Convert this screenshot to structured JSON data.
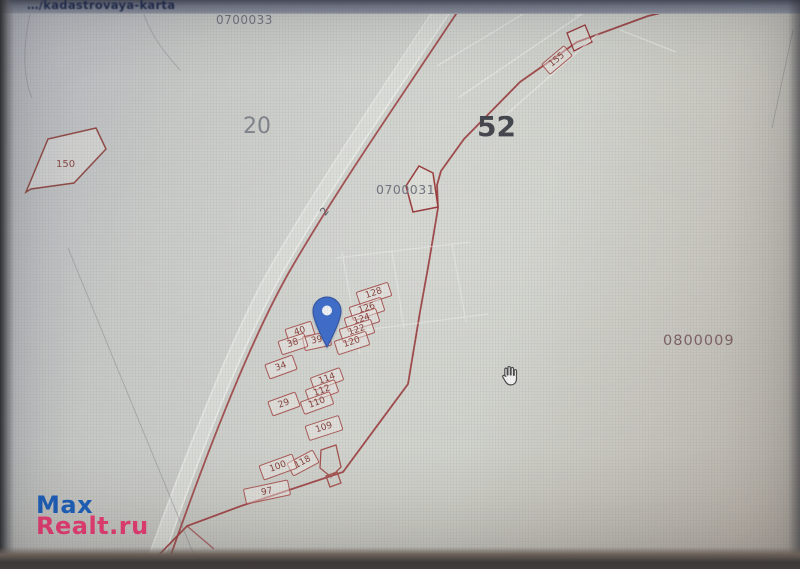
{
  "browser": {
    "address_fragment": "…/kadastrovaya-karta"
  },
  "map": {
    "labels": {
      "q_top": "0700033",
      "zone_left": "20",
      "zone_right": "52",
      "q_mid": "0700031",
      "q_right": "0800009",
      "road": "2",
      "parcel_150": "150"
    },
    "parcels": [
      {
        "label": "128",
        "x": 374,
        "y": 294,
        "w": 34,
        "h": 15,
        "rot": -18
      },
      {
        "label": "126",
        "x": 367,
        "y": 309,
        "w": 34,
        "h": 15,
        "rot": -18
      },
      {
        "label": "124",
        "x": 362,
        "y": 320,
        "w": 34,
        "h": 15,
        "rot": -18
      },
      {
        "label": "122",
        "x": 357,
        "y": 331,
        "w": 34,
        "h": 15,
        "rot": -18
      },
      {
        "label": "120",
        "x": 352,
        "y": 343,
        "w": 34,
        "h": 15,
        "rot": -18
      },
      {
        "label": "40",
        "x": 300,
        "y": 332,
        "w": 28,
        "h": 15,
        "rot": -18
      },
      {
        "label": "39",
        "x": 317,
        "y": 341,
        "w": 28,
        "h": 15,
        "rot": -12
      },
      {
        "label": "38",
        "x": 293,
        "y": 344,
        "w": 28,
        "h": 15,
        "rot": -18
      },
      {
        "label": "34",
        "x": 281,
        "y": 367,
        "w": 30,
        "h": 16,
        "rot": -20
      },
      {
        "label": "114",
        "x": 327,
        "y": 379,
        "w": 32,
        "h": 14,
        "rot": -20
      },
      {
        "label": "112",
        "x": 322,
        "y": 391,
        "w": 32,
        "h": 14,
        "rot": -20
      },
      {
        "label": "110",
        "x": 317,
        "y": 403,
        "w": 32,
        "h": 14,
        "rot": -20
      },
      {
        "label": "29",
        "x": 284,
        "y": 404,
        "w": 30,
        "h": 16,
        "rot": -20
      },
      {
        "label": "109",
        "x": 324,
        "y": 428,
        "w": 36,
        "h": 16,
        "rot": -18
      },
      {
        "label": "118",
        "x": 303,
        "y": 463,
        "w": 30,
        "h": 15,
        "rot": -28
      },
      {
        "label": "100",
        "x": 278,
        "y": 467,
        "w": 36,
        "h": 16,
        "rot": -20
      },
      {
        "label": "97",
        "x": 267,
        "y": 492,
        "w": 46,
        "h": 16,
        "rot": -12
      },
      {
        "label": "155",
        "x": 557,
        "y": 60,
        "w": 30,
        "h": 14,
        "rot": -40
      }
    ],
    "pin": {
      "x": 327,
      "y": 348
    },
    "cursor": {
      "type": "hand",
      "x": 510,
      "y": 376
    }
  },
  "watermark": {
    "line1": "Max",
    "line2": "Realt.ru"
  },
  "colors": {
    "boundary_red": "#9a3b3c",
    "parcel_red": "#a3524e",
    "pin_blue": "#3e6cc9",
    "watermark_blue": "#1b5cb5",
    "watermark_pink": "#e23a6e"
  }
}
